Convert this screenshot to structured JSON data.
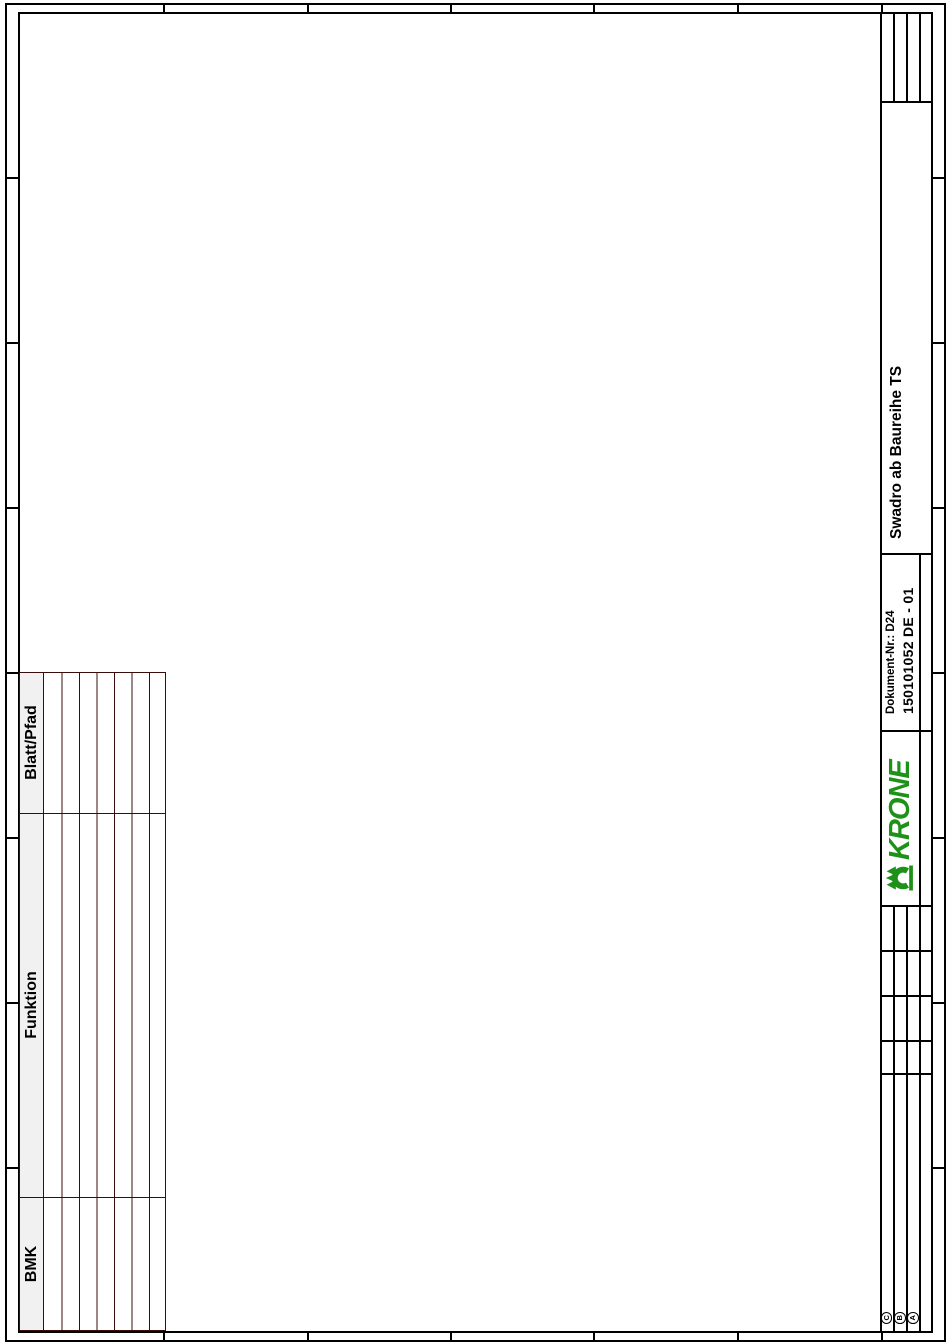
{
  "document": {
    "product_line": "Swadro ab Baureihe TS",
    "document_label": "Dokument-Nr.: D24",
    "document_number": "150101052 DE - 01"
  },
  "brand": {
    "logo_text": "KRONE",
    "logo_color": "#1e9118"
  },
  "reference_table": {
    "column_headers": [
      "BMK",
      "Funktion",
      "Blatt/Pfad"
    ],
    "visible_row_count": 7
  },
  "revision_marks": [
    "C",
    "B",
    "A"
  ],
  "colors": {
    "frame_line": "#000000",
    "table_line": "#3a0d0d",
    "header_fill": "#f1f1f1"
  }
}
